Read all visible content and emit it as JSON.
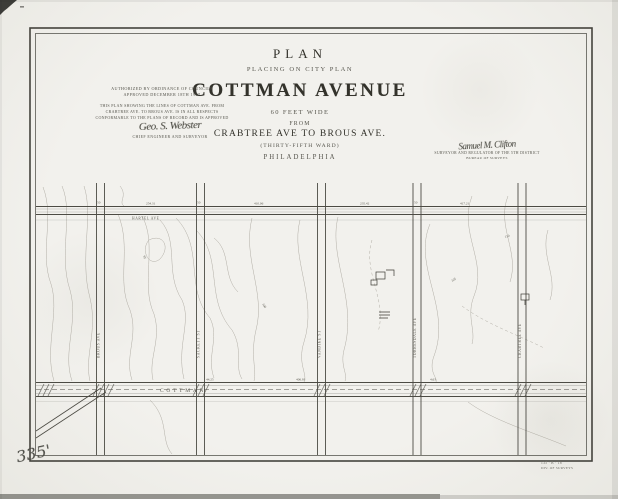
{
  "scan": {
    "paper": "#f1f0eb",
    "ink": "#33322b",
    "faint_ink": "#5d5b52",
    "street_line": "#4c4b44",
    "contour_line": "#a5a198"
  },
  "title_block": {
    "kicker": "PLAN",
    "subtitle": "PLACING ON CITY PLAN",
    "title": "COTTMAN AVENUE",
    "width_note": "60 FEET WIDE",
    "from_word": "FROM",
    "extent": "CRABTREE AVE TO BROUS AVE.",
    "ward": "(THIRTY-FIFTH WARD)",
    "city": "PHILADELPHIA"
  },
  "ordinance_block": {
    "auth_line1": "AUTHORIZED BY ORDINANCE OF COUNCILS",
    "auth_line2": "APPROVED DECEMBER 18TH 1907",
    "note_line1": "THIS PLAN SHOWING THE LINES OF COTTMAN AVE. FROM",
    "note_line2": "CRABTREE AVE. TO BROUS AVE. IS IN ALL RESPECTS",
    "note_line3": "CONFORMABLE TO THE PLANS OF RECORD AND IS APPROVED",
    "signature": "Geo. S. Webster",
    "signature_title": "CHIEF ENGINEER AND SURVEYOR"
  },
  "approval_block": {
    "signature": "Samuel M. Clifton",
    "title_line1": "SURVEYOR AND REGULATOR OF THE 5TH DISTRICT",
    "title_line2": "BUREAU OF SURVEYS"
  },
  "map": {
    "top_street_label": "HARTEL AVE",
    "main_street_label": "COTTMAN",
    "vertical_streets": [
      "BROUS AVE",
      "SACKETT ST",
      "VANDIKE ST",
      "TORRESDALE AVE",
      "CRABTREE AVE"
    ],
    "dims": {
      "d1": "254.31",
      "d2": "410.06",
      "d3": "235.42",
      "d4": "417.21",
      "d5": "50",
      "d6": "44.25",
      "d7": "406.93",
      "d8": "4.63"
    },
    "elevations": {
      "e1": "95",
      "e2": "100",
      "e3": "105",
      "e4": "110"
    }
  },
  "annotations": {
    "plate_number": "335'",
    "corner_ref_line1": "135 · B · 18",
    "corner_ref_line2": "DIV. OF SURVEYS"
  }
}
